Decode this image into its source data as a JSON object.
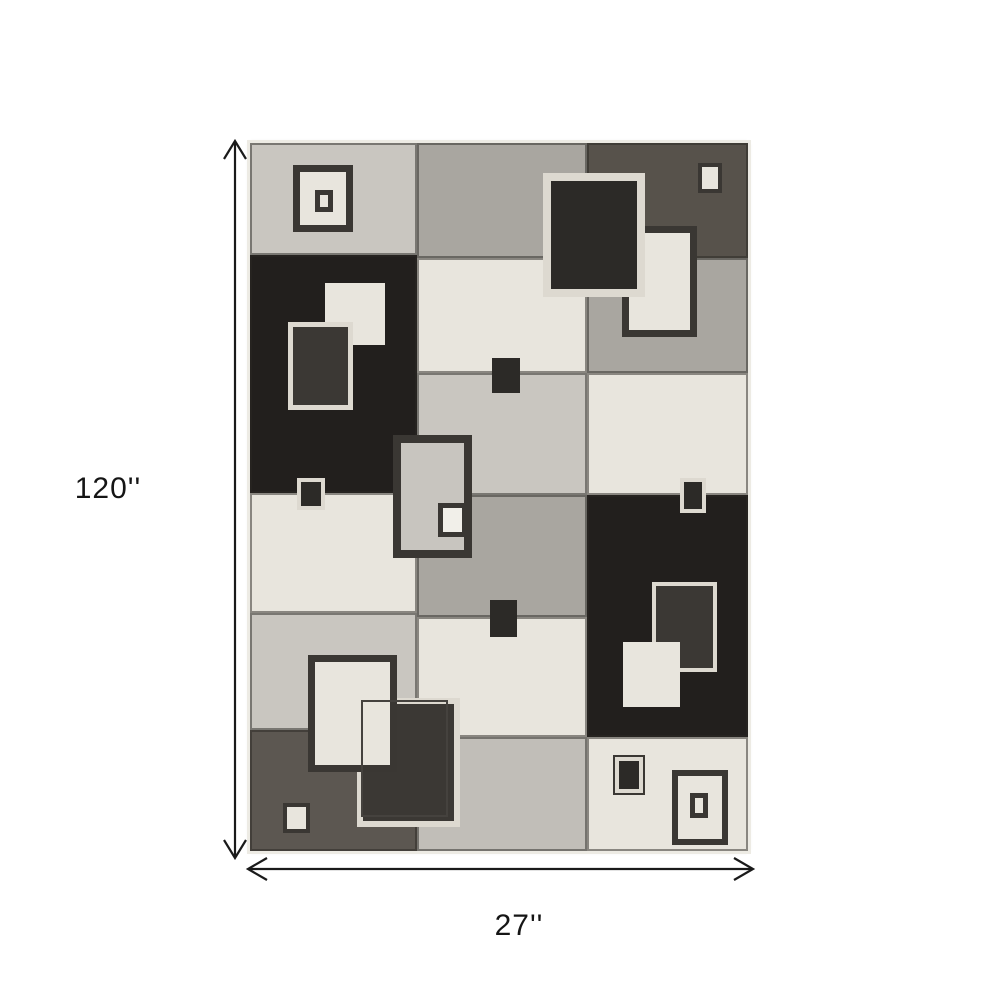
{
  "diagram": {
    "type": "product-dimension-diagram",
    "height_label": "120''",
    "width_label": "27''",
    "arrow_color": "#1a1a1a",
    "text_color": "#151515",
    "background": "#ffffff"
  },
  "rug": {
    "x": 250,
    "y": 143,
    "width": 498,
    "height": 708,
    "edge_color": "#edebe4",
    "seam_color": "rgba(42,40,36,0.50)",
    "palette": {
      "lightgray": "#c9c6c0",
      "midgray": "#a9a6a0",
      "midgray2": "#c1beb8",
      "cream": "#e8e5dd",
      "black": "#221f1d",
      "darkheather": "#57524b",
      "darkgray": "#5c5751",
      "creamframe": "#ddd9d0",
      "darkframe": "#3a3733",
      "darkfill": "#3b3834",
      "darkfill2": "#2c2a27",
      "white": "#f1efe9",
      "crackle": "#c8c5bf",
      "outline": "#45423e"
    },
    "cells": [
      {
        "x": 0,
        "y": 0,
        "w": 167,
        "h": 112,
        "color": "lightgray",
        "tex": "streaks-light"
      },
      {
        "x": 0,
        "y": 112,
        "w": 167,
        "h": 238,
        "color": "black",
        "tex": "streaks-dark"
      },
      {
        "x": 0,
        "y": 350,
        "w": 167,
        "h": 120,
        "color": "cream",
        "tex": "streaks-light"
      },
      {
        "x": 0,
        "y": 470,
        "w": 167,
        "h": 117,
        "color": "lightgray",
        "tex": "streaks-light"
      },
      {
        "x": 0,
        "y": 587,
        "w": 167,
        "h": 121,
        "color": "darkgray",
        "tex": "streaks-dark"
      },
      {
        "x": 167,
        "y": 0,
        "w": 170,
        "h": 115,
        "color": "midgray",
        "tex": "streaks-light"
      },
      {
        "x": 167,
        "y": 115,
        "w": 170,
        "h": 115,
        "color": "cream",
        "tex": "streaks-light"
      },
      {
        "x": 167,
        "y": 230,
        "w": 170,
        "h": 122,
        "color": "lightgray",
        "tex": "streaks-light"
      },
      {
        "x": 167,
        "y": 352,
        "w": 170,
        "h": 122,
        "color": "midgray",
        "tex": "streaks-light"
      },
      {
        "x": 167,
        "y": 474,
        "w": 170,
        "h": 120,
        "color": "cream",
        "tex": "streaks-light"
      },
      {
        "x": 167,
        "y": 594,
        "w": 170,
        "h": 114,
        "color": "midgray2",
        "tex": "streaks-light"
      },
      {
        "x": 337,
        "y": 0,
        "w": 161,
        "h": 115,
        "color": "darkheather",
        "tex": "streaks-dark"
      },
      {
        "x": 337,
        "y": 115,
        "w": 161,
        "h": 115,
        "color": "midgray",
        "tex": "streaks-light"
      },
      {
        "x": 337,
        "y": 230,
        "w": 161,
        "h": 122,
        "color": "cream",
        "tex": "streaks-light"
      },
      {
        "x": 337,
        "y": 352,
        "w": 161,
        "h": 242,
        "color": "black",
        "tex": "streaks-dark"
      },
      {
        "x": 337,
        "y": 594,
        "w": 161,
        "h": 114,
        "color": "cream",
        "tex": "streaks-light"
      }
    ],
    "motifs": [
      {
        "x": 43,
        "y": 22,
        "w": 60,
        "h": 67,
        "fill": "cream",
        "tex": "crackle",
        "border": "darkframe",
        "bw": 7,
        "z": 2
      },
      {
        "x": 65,
        "y": 47,
        "w": 18,
        "h": 22,
        "fill": "cream",
        "border": "darkframe",
        "bw": 5,
        "z": 3
      },
      {
        "x": 448,
        "y": 20,
        "w": 24,
        "h": 30,
        "fill": "cream",
        "border": "darkframe",
        "bw": 4,
        "z": 2
      },
      {
        "x": 372,
        "y": 83,
        "w": 75,
        "h": 111,
        "fill": "cream",
        "tex": "crackle",
        "border": "darkframe",
        "bw": 7,
        "z": 2
      },
      {
        "x": 293,
        "y": 30,
        "w": 102,
        "h": 124,
        "fill": "darkfill2",
        "tex": "speckle",
        "border": "creamframe",
        "bw": 8,
        "z": 3
      },
      {
        "x": 75,
        "y": 140,
        "w": 60,
        "h": 62,
        "fill": "cream",
        "tex": "crackle",
        "bw": 0,
        "z": 2
      },
      {
        "x": 38,
        "y": 179,
        "w": 65,
        "h": 88,
        "fill": "darkfill",
        "tex": "speckle",
        "border": "creamframe",
        "bw": 5,
        "z": 3
      },
      {
        "x": 47,
        "y": 335,
        "w": 28,
        "h": 32,
        "fill": "darkfill2",
        "border": "creamframe",
        "bw": 4,
        "z": 2
      },
      {
        "x": 143,
        "y": 292,
        "w": 79,
        "h": 123,
        "fill": "crackle",
        "tex": "crackle",
        "border": "darkframe",
        "bw": 8,
        "z": 2
      },
      {
        "x": 188,
        "y": 360,
        "w": 29,
        "h": 34,
        "fill": "white",
        "border": "darkframe",
        "bw": 5,
        "z": 3
      },
      {
        "x": 242,
        "y": 215,
        "w": 28,
        "h": 35,
        "fill": "darkfill2",
        "bw": 0,
        "z": 2
      },
      {
        "x": 240,
        "y": 457,
        "w": 27,
        "h": 37,
        "fill": "darkfill2",
        "bw": 0,
        "z": 2
      },
      {
        "x": 430,
        "y": 335,
        "w": 26,
        "h": 35,
        "fill": "darkfill2",
        "border": "creamframe",
        "bw": 4,
        "z": 2
      },
      {
        "x": 402,
        "y": 439,
        "w": 65,
        "h": 90,
        "fill": "darkfill",
        "tex": "speckle",
        "border": "creamframe",
        "bw": 4,
        "z": 2
      },
      {
        "x": 373,
        "y": 499,
        "w": 57,
        "h": 65,
        "fill": "cream",
        "tex": "crackle",
        "bw": 0,
        "z": 3
      },
      {
        "x": 365,
        "y": 614,
        "w": 28,
        "h": 36,
        "fill": "darkfill2",
        "border": "creamframe",
        "bw": 4,
        "ring": true,
        "z": 2
      },
      {
        "x": 422,
        "y": 627,
        "w": 56,
        "h": 75,
        "fill": "cream",
        "tex": "crackle",
        "border": "darkframe",
        "bw": 6,
        "z": 2
      },
      {
        "x": 440,
        "y": 650,
        "w": 18,
        "h": 25,
        "fill": "cream",
        "border": "darkframe",
        "bw": 5,
        "z": 3
      },
      {
        "x": 107,
        "y": 555,
        "w": 103,
        "h": 129,
        "fill": "darkfill",
        "tex": "speckle",
        "border": "creamframe",
        "bw": 6,
        "z": 3
      },
      {
        "x": 58,
        "y": 512,
        "w": 89,
        "h": 117,
        "fill": "cream",
        "tex": "crackle",
        "border": "darkframe",
        "bw": 7,
        "z": 4
      },
      {
        "x": 111,
        "y": 557,
        "w": 87,
        "h": 117,
        "fill": null,
        "border": "outline",
        "bw": 2,
        "z": 5
      },
      {
        "x": 33,
        "y": 660,
        "w": 27,
        "h": 30,
        "fill": "cream",
        "border": "darkframe",
        "bw": 4,
        "z": 2
      }
    ]
  }
}
